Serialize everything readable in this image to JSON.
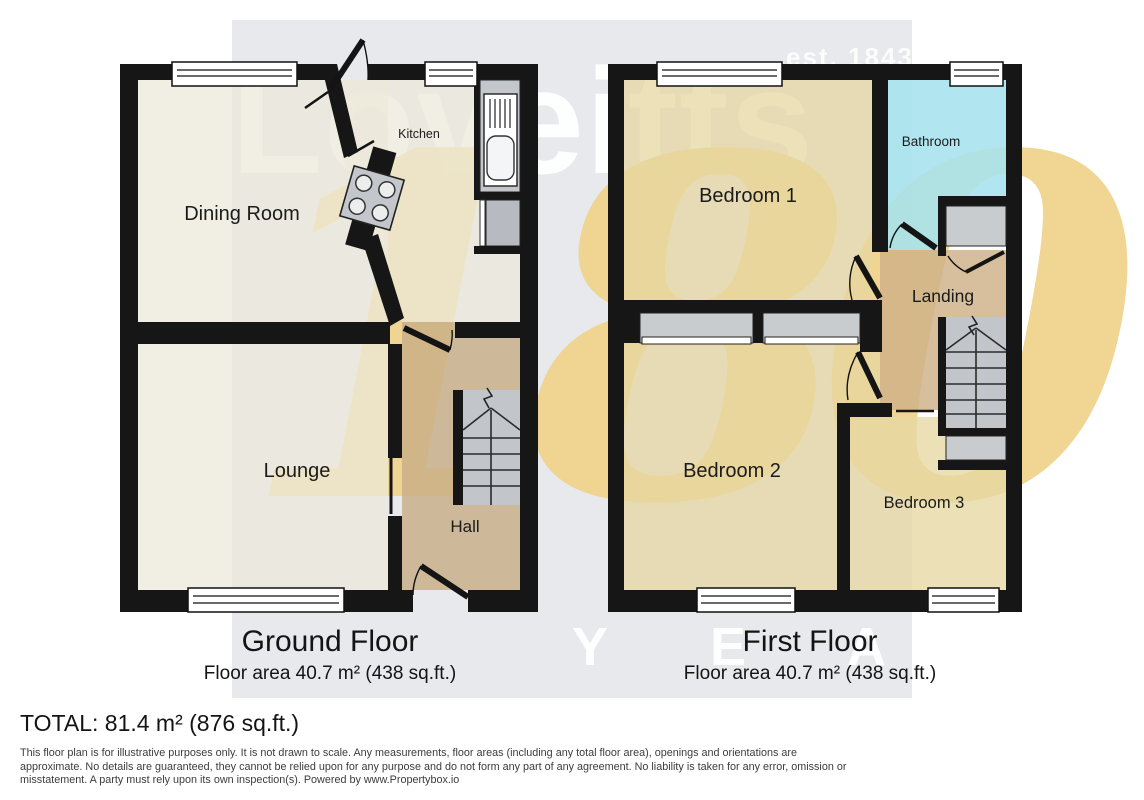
{
  "brand": {
    "name": "Loveitts",
    "established": "est. 1843",
    "anniversary_number": "180",
    "anniversary_word": "Y E A R S"
  },
  "ground_floor": {
    "title": "Ground Floor",
    "area_label": "Floor area 40.7 m² (438 sq.ft.)",
    "rooms": {
      "dining": "Dining Room",
      "kitchen": "Kitchen",
      "lounge": "Lounge",
      "hall": "Hall"
    }
  },
  "first_floor": {
    "title": "First Floor",
    "area_label": "Floor area 40.7 m² (438 sq.ft.)",
    "rooms": {
      "bedroom1": "Bedroom 1",
      "bathroom": "Bathroom",
      "landing": "Landing",
      "bedroom2": "Bedroom 2",
      "bedroom3": "Bedroom 3"
    }
  },
  "footer": {
    "total": "TOTAL: 81.4 m² (876 sq.ft.)",
    "disclaimer_lines": [
      "This floor plan is for illustrative purposes only. It is not drawn to scale. Any measurements, floor areas (including any total floor area), openings and orientations are",
      "approximate. No details are guaranteed, they cannot be relied upon for any purpose and do not form any part of any agreement. No liability is taken for any error, omission or",
      "misstatement. A party must rely upon its own inspection(s). Powered by www.Propertybox.io"
    ]
  },
  "colors": {
    "band": "#e7e9ec",
    "wall": "#161616",
    "cream": "#eceadb",
    "hall_tan": "#c7ad85",
    "bedroom_tan": "#e5d7a1",
    "bathroom_cyan": "#a6e3ee",
    "landing_tan": "#cfb189",
    "stair_gray": "#c2c6cb",
    "cupboard_gray": "#c9cccf",
    "counter_gray": "#c3c7cb",
    "appliance_gray": "#b7bbc1",
    "gold": "#f0d48d"
  }
}
